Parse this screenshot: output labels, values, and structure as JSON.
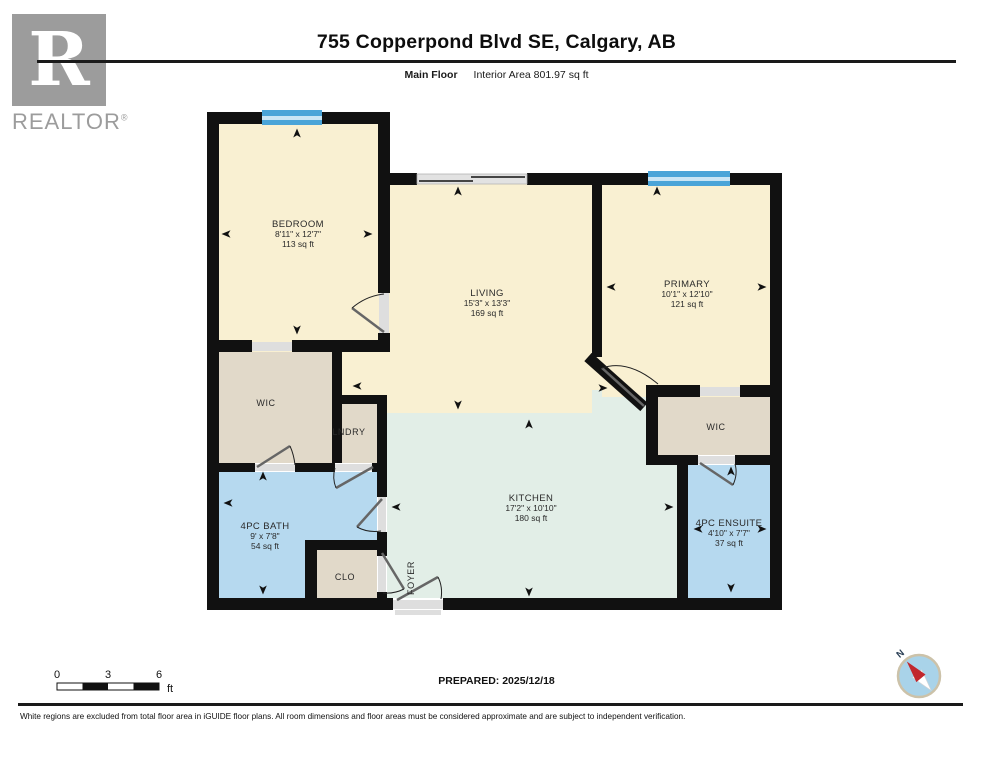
{
  "header": {
    "title": "755 Copperpond Blvd SE, Calgary, AB",
    "floor_label": "Main Floor",
    "area_label": "Interior Area 801.97 sq ft"
  },
  "logo": {
    "letter": "R",
    "brand": "REALTOR",
    "registered": "®"
  },
  "rooms": {
    "bedroom": {
      "name": "BEDROOM",
      "dims": "8'11\" x 12'7\"",
      "area": "113 sq ft"
    },
    "living": {
      "name": "LIVING",
      "dims": "15'3\" x 13'3\"",
      "area": "169 sq ft"
    },
    "primary": {
      "name": "PRIMARY",
      "dims": "10'1\" x 12'10\"",
      "area": "121 sq ft"
    },
    "wic_left": {
      "name": "WIC"
    },
    "wic_right": {
      "name": "WIC"
    },
    "laundry": {
      "name": "LNDRY"
    },
    "bath": {
      "name": "4PC BATH",
      "dims": "9' x 7'8\"",
      "area": "54 sq ft"
    },
    "kitchen": {
      "name": "KITCHEN",
      "dims": "17'2\" x 10'10\"",
      "area": "180 sq ft"
    },
    "ensuite": {
      "name": "4PC ENSUITE",
      "dims": "4'10\" x 7'7\"",
      "area": "37 sq ft"
    },
    "closet": {
      "name": "CLO"
    },
    "foyer": {
      "name": "FOYER"
    }
  },
  "scale_bar": {
    "ticks": [
      "0",
      "3",
      "6"
    ],
    "unit": "ft"
  },
  "compass": {
    "north_label": "N"
  },
  "prepared": {
    "label": "PREPARED: 2025/12/18"
  },
  "disclaimer": "White regions are excluded from total floor area in iGUIDE floor plans. All room dimensions and floor areas must be considered approximate and are subject to independent verification.",
  "colors": {
    "wall": "#111111",
    "room_cream": "#f9f0d2",
    "closet_tan": "#e1d9c9",
    "bath_blue": "#b6d9ef",
    "kitchen_green": "#e2eee7",
    "window_blue": "#4aa4d8",
    "window_light": "#c9e5f5",
    "opening_gray": "#dedede",
    "text_dark": "#2a2a2a",
    "logo_gray": "#9c9c9c",
    "compass_blue": "#a9d3e9",
    "compass_ring": "#ccc2a9",
    "needle_red": "#c1272d"
  }
}
